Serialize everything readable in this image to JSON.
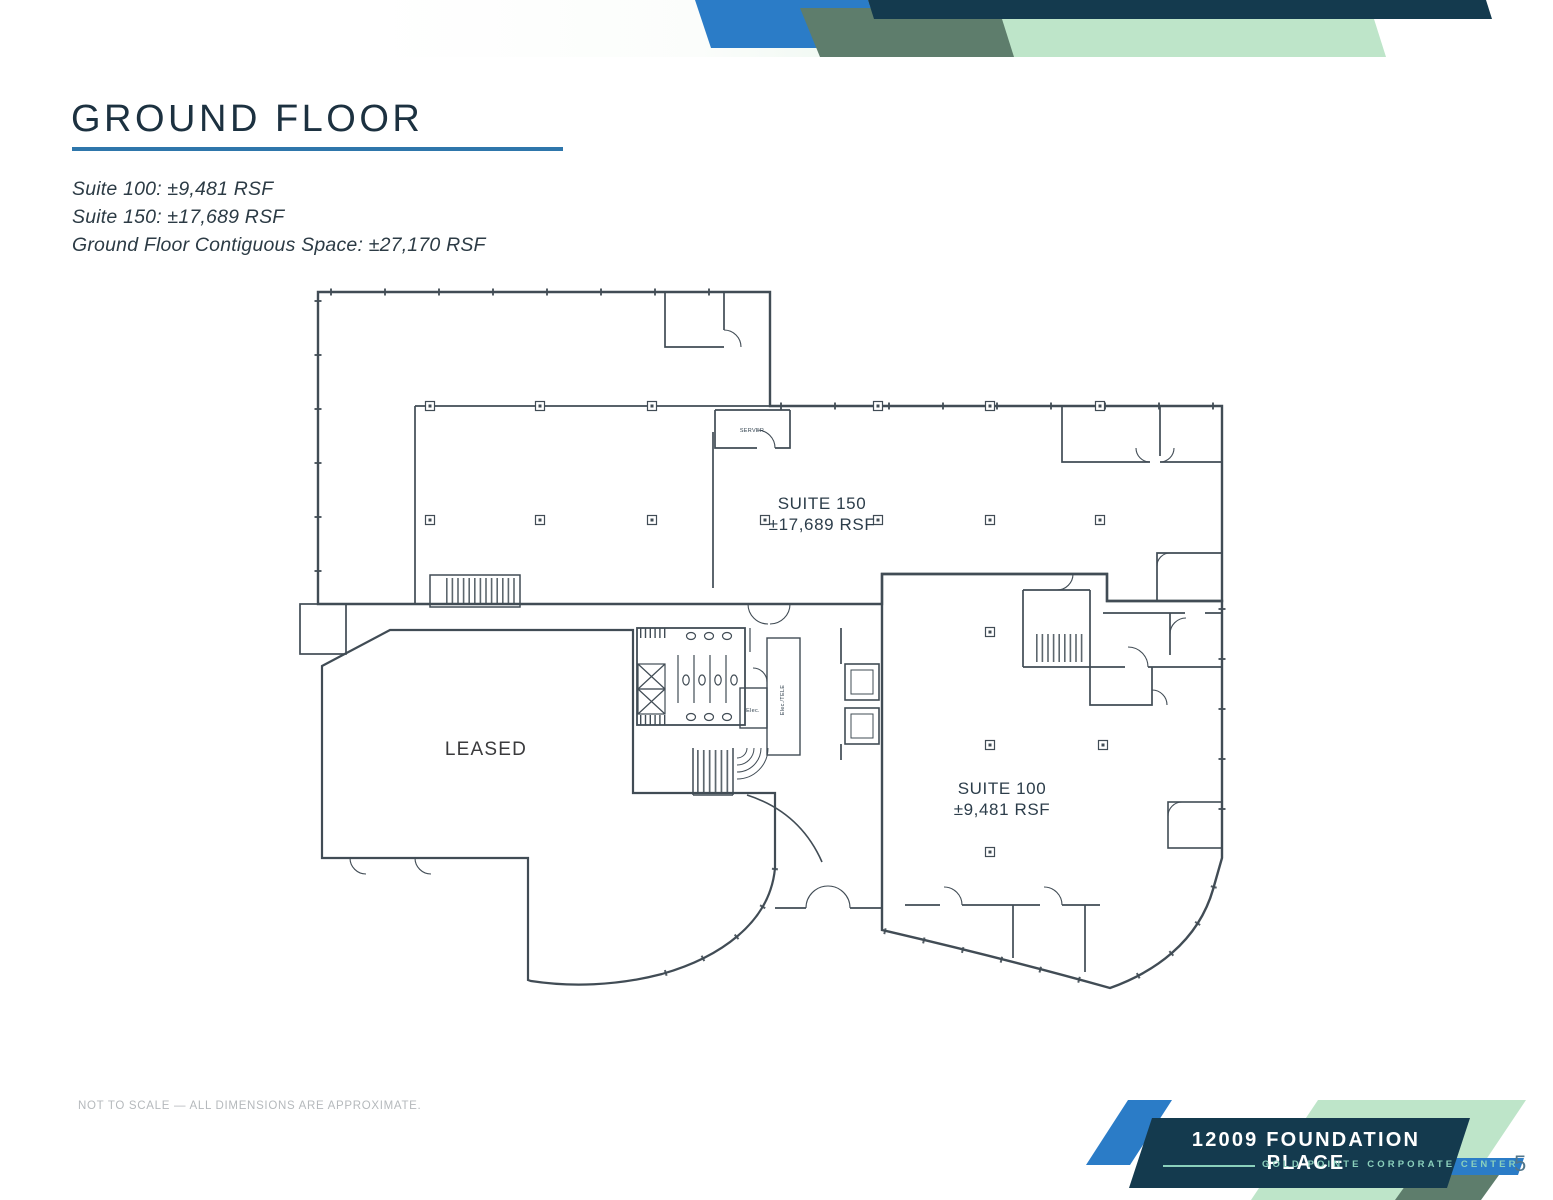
{
  "header": {
    "title": "GROUND FLOOR",
    "stats": [
      "Suite 100: ±9,481 RSF",
      "Suite 150: ±17,689 RSF",
      "Ground Floor Contiguous Space: ±27,170 RSF"
    ]
  },
  "floorplan": {
    "suite150": {
      "label": "SUITE 150",
      "area": "±17,689 RSF",
      "fill": "#c9daed"
    },
    "suite100": {
      "label": "SUITE 100",
      "area": "±9,481 RSF",
      "fill": "#dfeedf"
    },
    "leased": {
      "label": "LEASED",
      "fill": "#bcbcbe"
    },
    "rooms": {
      "server": "SERVER",
      "elec": "Elec.",
      "elec_tele": "Elec./TELE"
    }
  },
  "footer": {
    "disclaimer": "NOT TO SCALE — ALL DIMENSIONS ARE APPROXIMATE.",
    "building_name": "12009 FOUNDATION PLACE",
    "campus_name": "GOLD POINTE CORPORATE CENTER",
    "page_number": "5"
  },
  "colors": {
    "navy": "#143a4e",
    "blue": "#2b7cc7",
    "sage": "#5e7d6c",
    "light_green": "#bee5c9",
    "underline_blue": "#2e76ab"
  }
}
